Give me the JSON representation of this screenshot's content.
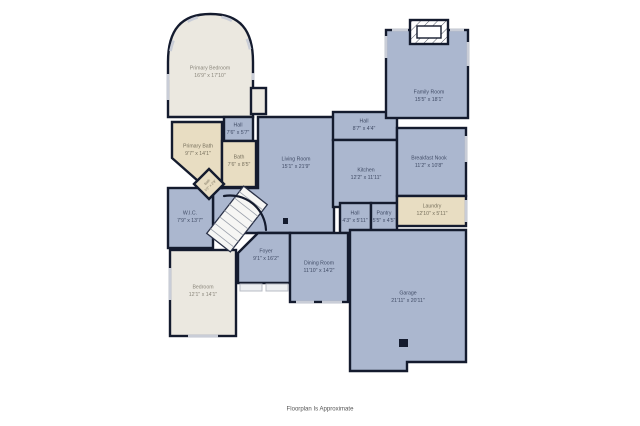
{
  "page": {
    "footer": "Floorplan Is Approximate"
  },
  "palette": {
    "wall": "#141b2e",
    "blue": "#abb7cf",
    "tan": "#e8ddc2",
    "cream": "#ebe8e0",
    "window": "#c9cdd7",
    "label": "#414c66",
    "label_light": "#8a867b",
    "label_tan": "#77705d",
    "footer_text": "#555555"
  },
  "rooms": [
    {
      "id": "primary-bedroom",
      "name": "Primary Bedroom",
      "dims": "16'9\" x 17'10\""
    },
    {
      "id": "family-room",
      "name": "Family Room",
      "dims": "15'5\" x 18'1\""
    },
    {
      "id": "hall-upper",
      "name": "Hall",
      "dims": "7'6\" x 5'7\""
    },
    {
      "id": "primary-bath",
      "name": "Primary Bath",
      "dims": "9'7\" x 14'1\""
    },
    {
      "id": "bath",
      "name": "Bath",
      "dims": "7'6\" x 8'5\""
    },
    {
      "id": "bath-small",
      "name": "Bath",
      "dims": "5'2\" x 2'9\""
    },
    {
      "id": "living-room",
      "name": "Living Room",
      "dims": "15'1\" x 21'9\""
    },
    {
      "id": "hall-family",
      "name": "Hall",
      "dims": "8'7\" x 4'4\""
    },
    {
      "id": "kitchen",
      "name": "Kitchen",
      "dims": "12'2\" x 11'11\""
    },
    {
      "id": "breakfast-nook",
      "name": "Breakfast Nook",
      "dims": "11'2\" x 10'8\""
    },
    {
      "id": "laundry",
      "name": "Laundry",
      "dims": "12'10\" x 5'11\""
    },
    {
      "id": "hall-center",
      "name": "Hall",
      "dims": "4'3\" x 5'11\""
    },
    {
      "id": "pantry",
      "name": "Pantry",
      "dims": "5'5\" x 4'5\""
    },
    {
      "id": "wic",
      "name": "W.I.C.",
      "dims": "7'9\" x 13'7\""
    },
    {
      "id": "foyer",
      "name": "Foyer",
      "dims": "9'1\" x 16'2\""
    },
    {
      "id": "dining-room",
      "name": "Dining Room",
      "dims": "11'10\" x 14'2\""
    },
    {
      "id": "bedroom",
      "name": "Bedroom",
      "dims": "12'1\" x 14'1\""
    },
    {
      "id": "garage",
      "name": "Garage",
      "dims": "21'11\" x 20'11\""
    }
  ]
}
